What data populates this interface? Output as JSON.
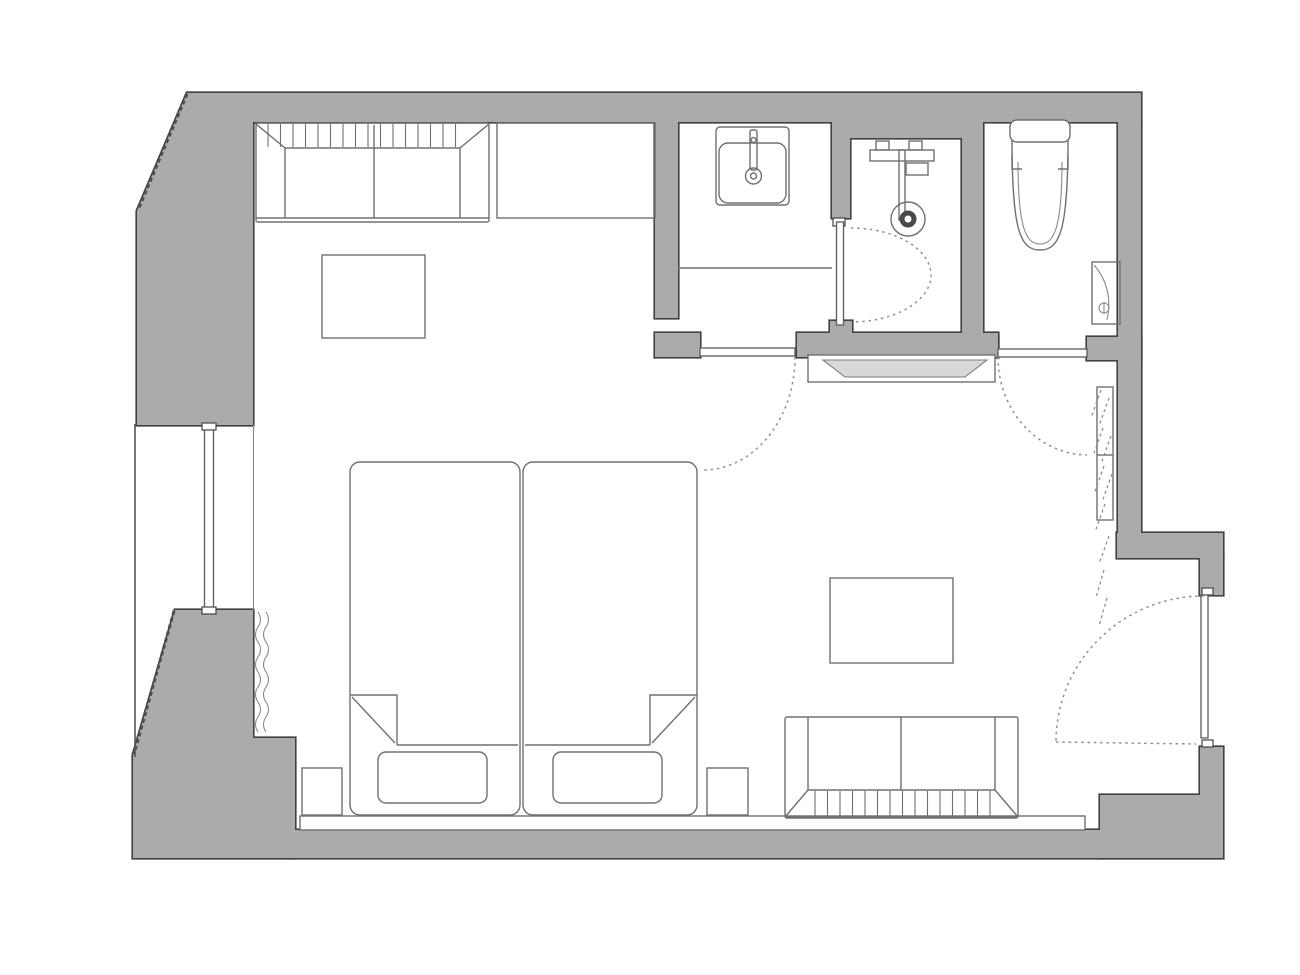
{
  "document": {
    "type": "architectural-floor-plan",
    "style": "hotel-guest-room plan, top-down, monochrome line drawing",
    "visible_text": []
  },
  "colors": {
    "background": "#ffffff",
    "wall_fill": "#ababab",
    "wall_outline": "#414141",
    "furniture_stroke": "#707070",
    "light_stroke": "#8a8a8a",
    "door_arc": "#909090",
    "bench_fill": "#d8d8d8"
  },
  "rooms": [
    {
      "name": "bedroom",
      "contents": [
        "sofa",
        "wall-counter",
        "side-table",
        "twin-bed-1",
        "twin-bed-2",
        "nightstands",
        "window",
        "curtain"
      ]
    },
    {
      "name": "vanity-room",
      "contents": [
        "wash-basin",
        "vanity-counter"
      ]
    },
    {
      "name": "shower-room",
      "contents": [
        "shower-mixer",
        "shower-drain"
      ]
    },
    {
      "name": "toilet-room",
      "contents": [
        "toilet",
        "toilet-paper-holder"
      ]
    },
    {
      "name": "living-area",
      "contents": [
        "coffee-table",
        "living-sofa",
        "luggage-bench",
        "wall-mirror"
      ]
    }
  ],
  "doors": [
    {
      "name": "bedroom-hall-door",
      "type": "hinged",
      "swing": "into-bedroom"
    },
    {
      "name": "shower-door",
      "type": "hinged",
      "swing": "into-shower"
    },
    {
      "name": "toilet-door",
      "type": "hinged",
      "swing": "into-living-area"
    },
    {
      "name": "entrance-door",
      "type": "hinged",
      "swing": "into-living-area"
    }
  ]
}
